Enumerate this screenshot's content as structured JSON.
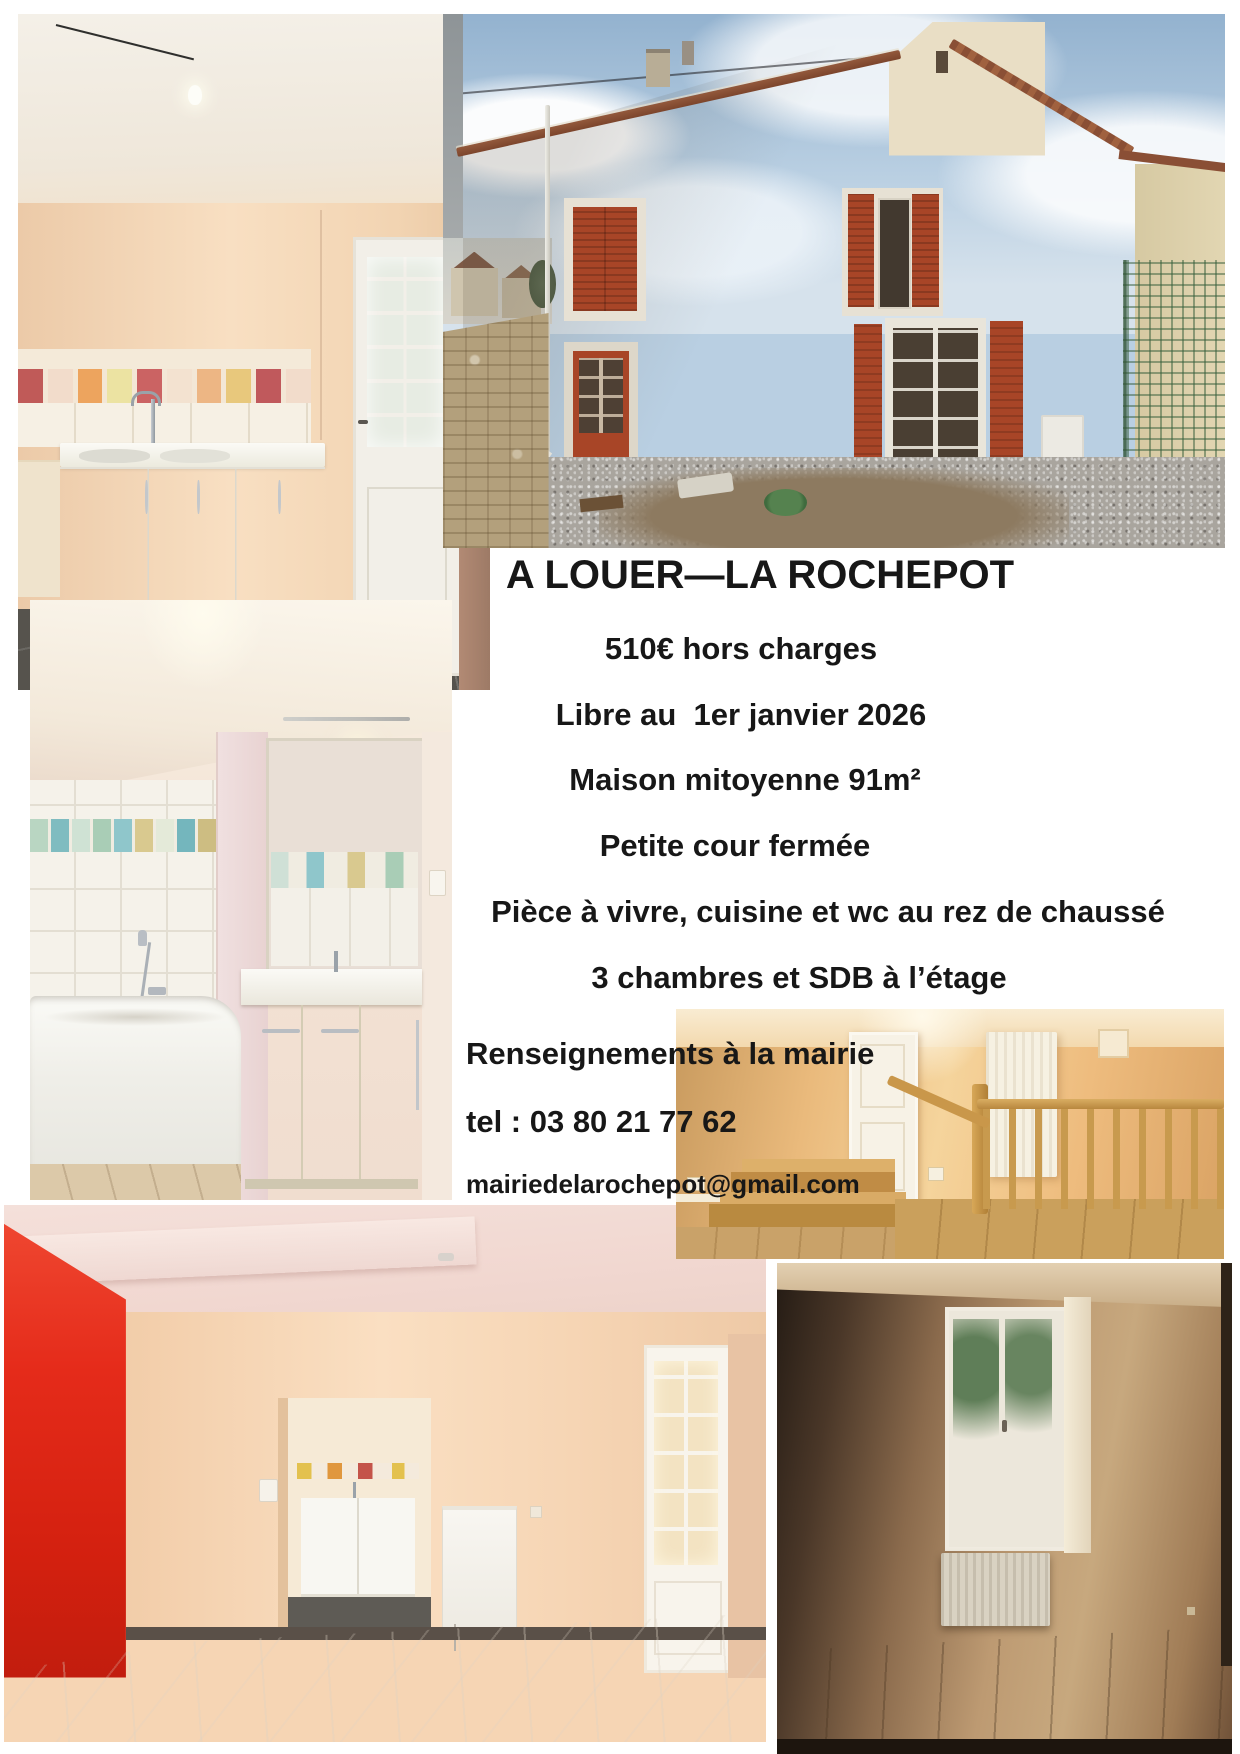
{
  "flyer": {
    "title": "A LOUER—LA ROCHEPOT",
    "details": [
      "510€ hors charges",
      "Libre au  1er janvier 2026",
      "Maison mitoyenne 91m²",
      "Petite cour fermée",
      "Pièce à vivre, cuisine et wc au rez de chaussé",
      "3 chambres et SDB à l’étage"
    ],
    "contact": {
      "info": "Renseignements à la mairie",
      "phone": "tel : 03 80 21 77 62",
      "email": "mairiedelarochepot@gmail.com"
    },
    "colors": {
      "text": "#1a1a1a",
      "page_background": "#ffffff",
      "shutter_red": "#a84527",
      "living_room_red": "#e52b1a",
      "facade_beige": "#ccc2b0",
      "sky_blue": "#a9c3da",
      "landing_orange": "#eebc7e"
    }
  }
}
